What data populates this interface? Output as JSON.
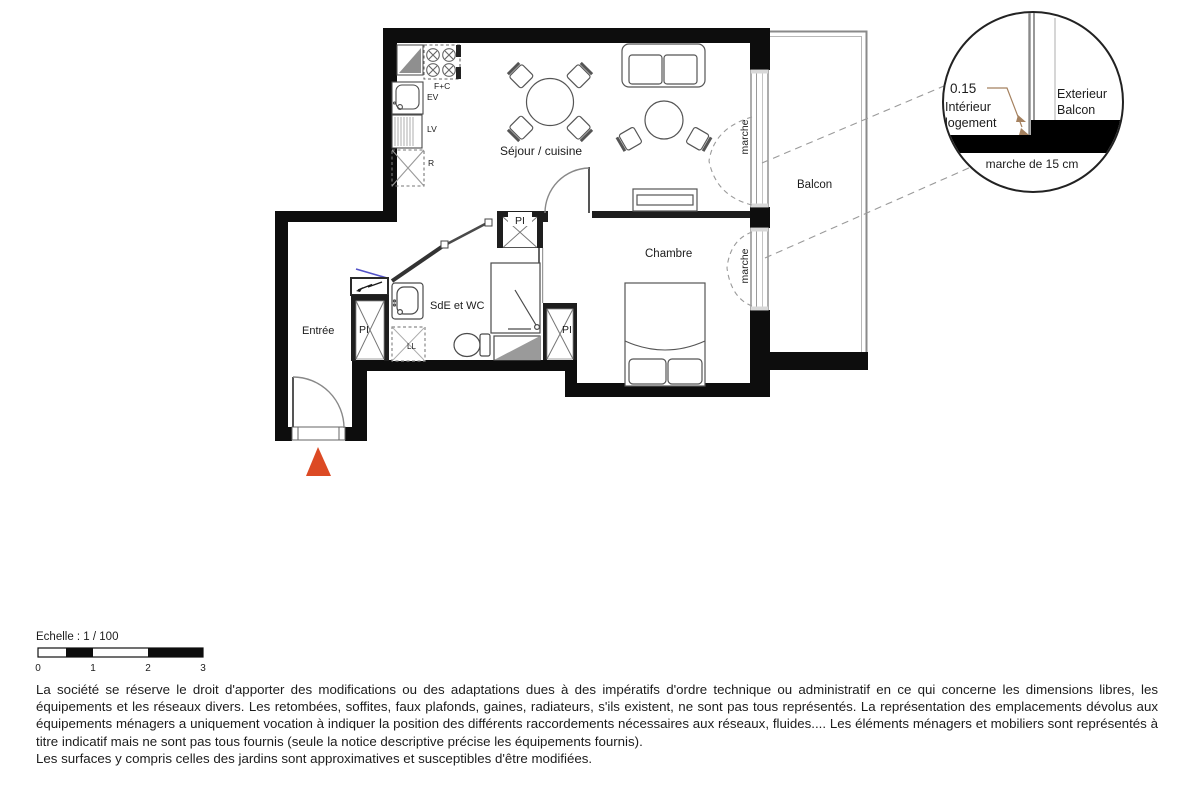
{
  "plan": {
    "rooms": {
      "living": "Séjour / cuisine",
      "bedroom": "Chambre",
      "entry": "Entrée",
      "bathroom": "SdE et WC",
      "balcony": "Balcon"
    },
    "closet": "PI",
    "kitchen": {
      "hob": "F+C",
      "sink": "EV",
      "dishwasher": "LV",
      "fridge": "R"
    },
    "laundry": "LL",
    "step": "marche",
    "colors": {
      "wall": "#0d0d0d",
      "entrance_marker": "#dc4a24",
      "dimension_text": "#a5815f",
      "door_blue": "#5353c8"
    }
  },
  "detail": {
    "dimension": "0.15",
    "interior_l1": "Intérieur",
    "interior_l2": "logement",
    "exterior_l1": "Exterieur",
    "exterior_l2": "Balcon",
    "caption": "marche de 15 cm"
  },
  "scalebar": {
    "label": "Echelle : 1 / 100",
    "ticks": [
      "0",
      "1",
      "2",
      "3"
    ]
  },
  "disclaimer": {
    "paragraph": "La société se réserve le droit d'apporter des modifications ou des adaptations dues à des impératifs d'ordre technique ou administratif en ce qui concerne les dimensions libres, les équipements et les réseaux divers. Les retombées, soffites, faux plafonds, gaines, radiateurs, s'ils existent, ne sont pas tous représentés. La représentation des emplacements dévolus aux équipements ménagers a uniquement vocation à indiquer la position des différents raccordements nécessaires aux réseaux, fluides.... Les éléments ménagers et mobiliers sont représentés à titre indicatif mais ne sont pas tous fournis (seule la notice descriptive précise les équipements fournis).",
    "surfaces": "Les surfaces y compris celles des jardins sont approximatives et susceptibles d'être modifiées."
  }
}
